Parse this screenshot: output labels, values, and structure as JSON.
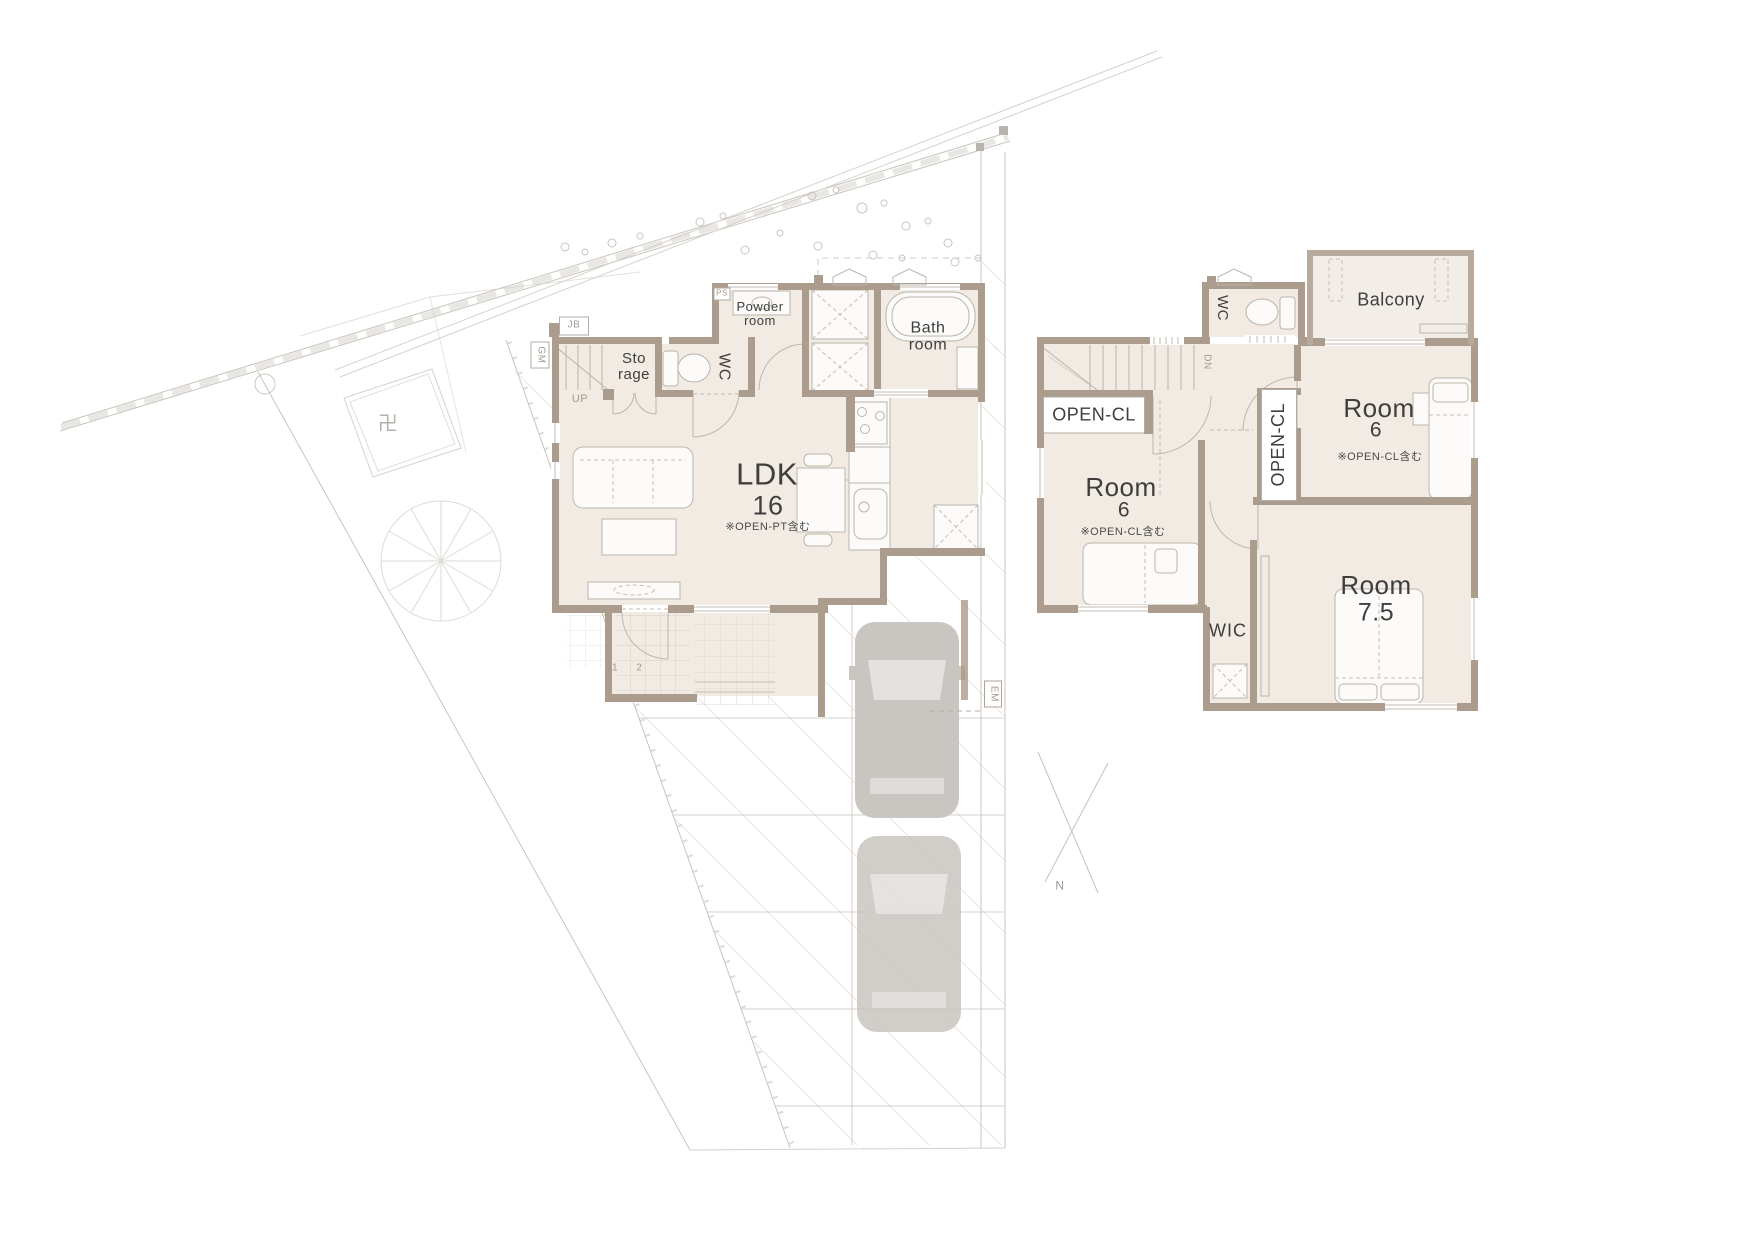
{
  "site": {
    "north_label": "N",
    "temple_symbol": "卍",
    "em_label": "EM",
    "jb_label": "JB",
    "gm_label": "GM"
  },
  "floor1": {
    "powder_line1": "Powder",
    "powder_line2": "room",
    "wc_label": "WC",
    "storage_line1": "Sto",
    "storage_line2": "rage",
    "up_label": "UP",
    "bath_line1": "Bath",
    "bath_line2": "room",
    "ldk_name": "LDK",
    "ldk_size": "16",
    "ldk_note": "※OPEN-PT含む",
    "ps_label": "PS",
    "genkan_numbers": "1 2"
  },
  "floor2": {
    "dn_label": "DN",
    "wc_label": "WC",
    "open_cl_west": "OPEN-CL",
    "open_cl_east": "OPEN-CL",
    "room6_west_name": "Room",
    "room6_west_size": "6",
    "room6_west_note": "※OPEN-CL含む",
    "room6_east_name": "Room",
    "room6_east_size": "6",
    "room6_east_note": "※OPEN-CL含む",
    "room75_name": "Room",
    "room75_size": "7.5",
    "wic_label": "WIC",
    "balcony_label": "Balcony"
  },
  "colors": {
    "wall": "#ab9c8e",
    "floor": "#f1ebe4",
    "balcony_wall": "#b8ab9d",
    "site_line": "#c9c5be",
    "car": "#c9c5c0",
    "text": "#3e3e3e",
    "muted": "#a09a91"
  }
}
